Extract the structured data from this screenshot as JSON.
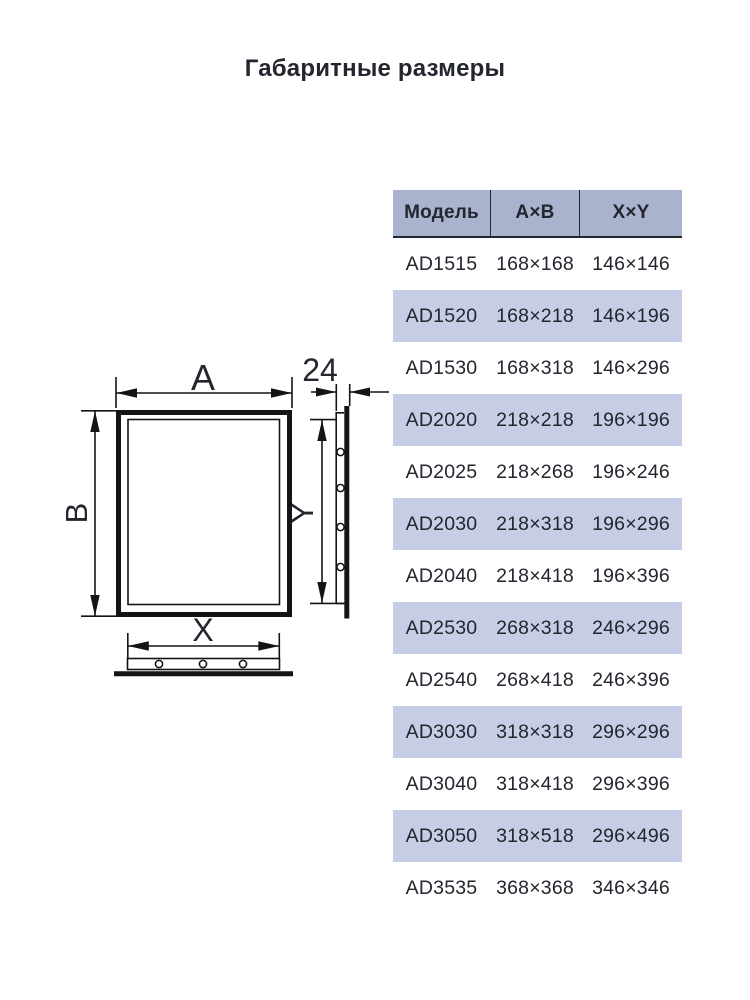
{
  "title": "Габаритные размеры",
  "table": {
    "headers": [
      "Модель",
      "А×В",
      "X×Y"
    ],
    "rows": [
      {
        "model": "AD1515",
        "ab": "168×168",
        "xy": "146×146"
      },
      {
        "model": "AD1520",
        "ab": "168×218",
        "xy": "146×196"
      },
      {
        "model": "AD1530",
        "ab": "168×318",
        "xy": "146×296"
      },
      {
        "model": "AD2020",
        "ab": "218×218",
        "xy": "196×196"
      },
      {
        "model": "AD2025",
        "ab": "218×268",
        "xy": "196×246"
      },
      {
        "model": "AD2030",
        "ab": "218×318",
        "xy": "196×296"
      },
      {
        "model": "AD2040",
        "ab": "218×418",
        "xy": "196×396"
      },
      {
        "model": "AD2530",
        "ab": "268×318",
        "xy": "246×296"
      },
      {
        "model": "AD2540",
        "ab": "268×418",
        "xy": "246×396"
      },
      {
        "model": "AD3030",
        "ab": "318×318",
        "xy": "296×296"
      },
      {
        "model": "AD3040",
        "ab": "318×418",
        "xy": "296×396"
      },
      {
        "model": "AD3050",
        "ab": "318×518",
        "xy": "296×496"
      },
      {
        "model": "AD3535",
        "ab": "368×368",
        "xy": "346×346"
      }
    ]
  },
  "diagram": {
    "label_a": "A",
    "label_b": "B",
    "label_x": "X",
    "label_y": "Y",
    "label_depth": "24"
  },
  "colors": {
    "header_bg": "#a9b3cd",
    "stripe_bg": "#c7cde4",
    "text": "#23262e",
    "line": "#141414"
  }
}
